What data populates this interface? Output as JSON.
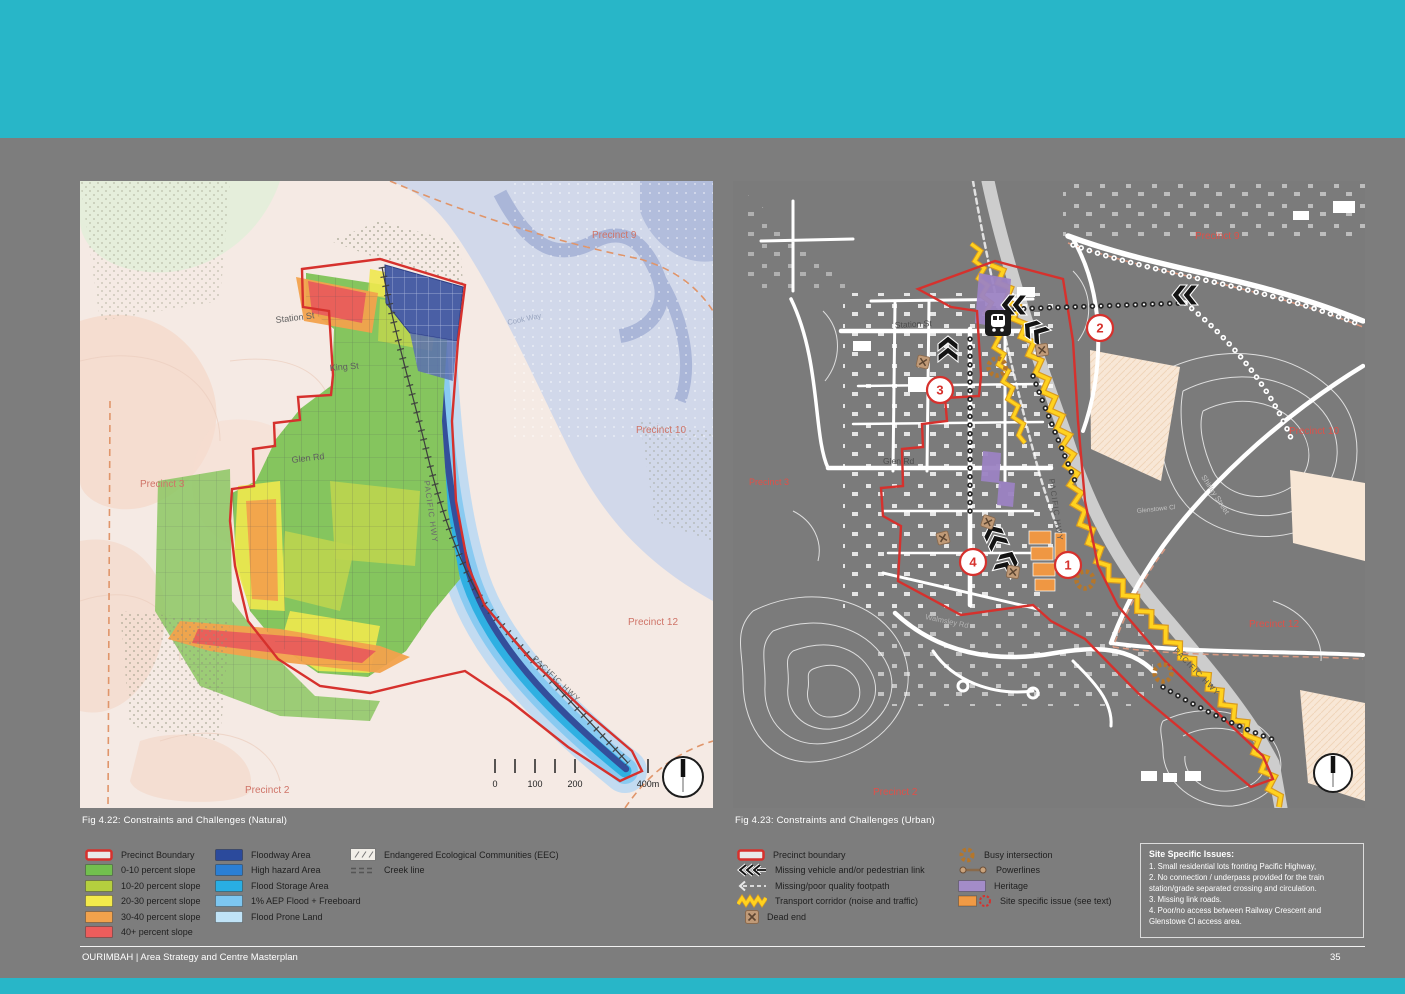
{
  "theme": {
    "teal": "#28b6c8",
    "page-bg": "#7d7d7d",
    "boundary-red": "#d6312d"
  },
  "left_figure": {
    "caption": "Fig 4.22: Constraints and Challenges (Natural)",
    "labels": {
      "station_st": "Station St",
      "king_st": "King St",
      "glen_rd": "Glen Rd",
      "pacific_hwy_a": "PACIFIC HWY",
      "pacific_hwy_b": "PACIFIC HWY",
      "cook_way": "Cook Way",
      "precinct_9": "Precinct 9",
      "precinct_10": "Precinct 10",
      "precinct_3": "Precinct 3",
      "precinct_12": "Precinct 12",
      "precinct_2": "Precinct 2"
    },
    "scalebar": [
      "0",
      "100",
      "200",
      "400m"
    ]
  },
  "right_figure": {
    "caption": "Fig 4.23: Constraints and Challenges (Urban)",
    "labels": {
      "station_st": "Station St",
      "glen_rd": "Glen Rd",
      "walmsley_rd": "Walmsley Rd",
      "pacific_hwy_a": "PACIFIC HWY",
      "pacific_hwy_b": "PACIFIC HWY",
      "shirley_st": "Shirley Street",
      "glenstowe_cl": "Glenstowe Cl",
      "precinct_9": "Precinct 9",
      "precinct_10": "Precinct 10",
      "precinct_3": "Precinct 3",
      "precinct_12": "Precinct 12",
      "precinct_2": "Precinct 2"
    },
    "markers": [
      "1",
      "2",
      "3",
      "4"
    ]
  },
  "legend_left": {
    "col1": [
      {
        "label": "Precinct Boundary",
        "color": "#d6312d"
      },
      {
        "label": "0-10 percent slope",
        "color": "#72bf4e"
      },
      {
        "label": "10-20 percent slope",
        "color": "#b5cf3e"
      },
      {
        "label": "20-30 percent slope",
        "color": "#f3ea4b"
      },
      {
        "label": "30-40 percent slope",
        "color": "#f2a24c"
      },
      {
        "label": "40+ percent slope",
        "color": "#ec5d5c"
      }
    ],
    "col2": [
      {
        "label": "Floodway Area",
        "color": "#2b4a9c"
      },
      {
        "label": "High hazard Area",
        "color": "#2b7fd4"
      },
      {
        "label": "Flood Storage Area",
        "color": "#29aee3"
      },
      {
        "label": "1% AEP Flood + Freeboard",
        "color": "#7dc6f0"
      },
      {
        "label": "Flood Prone Land",
        "color": "#c0e3f7"
      }
    ],
    "col3": [
      {
        "label": "Endangered Ecological Communities (EEC)"
      },
      {
        "label": "Creek line"
      }
    ]
  },
  "legend_right": {
    "col1": [
      {
        "label": "Precinct boundary",
        "color": "#d6312d"
      },
      {
        "label": "Missing vehicle and/or pedestrian link"
      },
      {
        "label": "Missing/poor quality footpath"
      },
      {
        "label": "Transport corridor (noise and traffic)",
        "color": "#ffd21f"
      },
      {
        "label": "Dead end"
      }
    ],
    "col2": [
      {
        "label": "Busy intersection",
        "color": "#b5762a"
      },
      {
        "label": "Powerlines"
      },
      {
        "label": "Heritage",
        "color": "#a38cc8"
      },
      {
        "label": "Site specific issue (see text)",
        "color": "#f09a45"
      }
    ]
  },
  "issues_box": {
    "title": "Site Specific Issues:",
    "lines": [
      "1. Small residential lots fronting Pacific Highway,",
      "2. No connection / underpass provided for the train",
      "station/grade separated crossing and circulation.",
      "3. Missing link roads.",
      "4. Poor/no access between Railway Crescent and",
      "Glenstowe Cl access area."
    ]
  },
  "footer": {
    "brand": "OURIMBAH | Area Strategy and Centre Masterplan",
    "page": "35"
  }
}
